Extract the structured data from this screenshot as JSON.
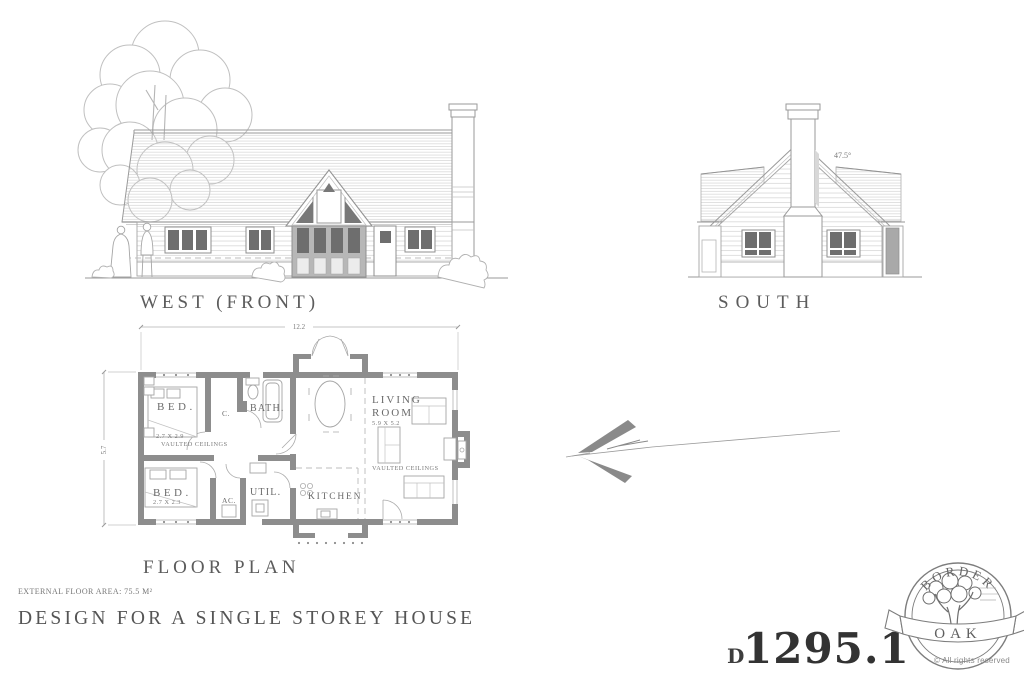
{
  "elevations": {
    "west": {
      "label": "WEST (FRONT)"
    },
    "south": {
      "label": "SOUTH",
      "roof_pitch": "47.5°"
    }
  },
  "floor_plan": {
    "label": "FLOOR PLAN",
    "dimensions": {
      "width": "12.2",
      "depth": "5.7"
    },
    "rooms": [
      {
        "name": "BED.",
        "size": "2.7 X 2.9",
        "note": "VAULTED CEILINGS"
      },
      {
        "name": "C."
      },
      {
        "name": "BATH."
      },
      {
        "name": "BED.",
        "size": "2.7 X 2.3"
      },
      {
        "name": "AC."
      },
      {
        "name": "UTIL."
      },
      {
        "name": "KITCHEN"
      },
      {
        "name": "LIVING ROOM",
        "name_words": [
          "LIVING",
          "ROOM"
        ],
        "size": "5.9 X 5.2",
        "note": "VAULTED CEILINGS"
      }
    ]
  },
  "footer": {
    "floor_area": "EXTERNAL FLOOR AREA: 75.5 M²",
    "title": "DESIGN FOR A SINGLE STOREY HOUSE",
    "drawing_prefix": "D",
    "drawing_number": "1295.1"
  },
  "logo": {
    "top": "BORDER",
    "banner": "OAK",
    "rights": "© All rights reserved"
  }
}
